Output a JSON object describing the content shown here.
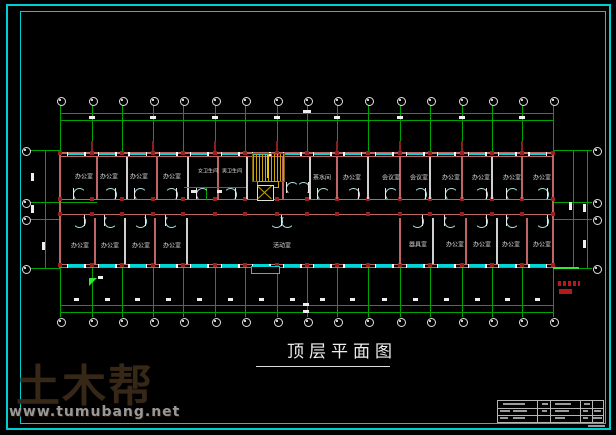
{
  "sheet": {
    "background": "#000000",
    "border_color": "#00cdd4"
  },
  "title": {
    "text": "顶层平面图"
  },
  "watermark": {
    "logo_text": "土木帮",
    "url_text": "www.tumubang.net"
  },
  "plan": {
    "grid_columns_x": [
      60,
      92,
      122,
      153,
      183,
      215,
      245,
      277,
      307,
      337,
      368,
      400,
      430,
      462,
      492,
      522,
      553
    ],
    "side_bubble_ys": [
      150,
      202,
      219,
      268
    ],
    "building": {
      "left": 60,
      "right": 553,
      "top": 152,
      "corridor_top": 199,
      "corridor_bottom": 214,
      "bottom": 267
    },
    "rooms_top": [
      {
        "label": "办公室",
        "x": 84,
        "y": 176
      },
      {
        "label": "办公室",
        "x": 109,
        "y": 176
      },
      {
        "label": "办公室",
        "x": 139,
        "y": 176
      },
      {
        "label": "办公室",
        "x": 172,
        "y": 176
      },
      {
        "label": "女卫生间",
        "x": 208,
        "y": 171,
        "fs": 5
      },
      {
        "label": "男卫生间",
        "x": 232,
        "y": 171,
        "fs": 5
      },
      {
        "label": "茶水间",
        "x": 322,
        "y": 177
      },
      {
        "label": "办公室",
        "x": 352,
        "y": 177
      },
      {
        "label": "会议室",
        "x": 391,
        "y": 177
      },
      {
        "label": "会议室",
        "x": 419,
        "y": 177
      },
      {
        "label": "办公室",
        "x": 451,
        "y": 177
      },
      {
        "label": "办公室",
        "x": 481,
        "y": 177
      },
      {
        "label": "办公室",
        "x": 512,
        "y": 177
      },
      {
        "label": "办公室",
        "x": 542,
        "y": 177
      }
    ],
    "rooms_bottom": [
      {
        "label": "办公室",
        "x": 80,
        "y": 245
      },
      {
        "label": "办公室",
        "x": 110,
        "y": 245
      },
      {
        "label": "办公室",
        "x": 141,
        "y": 245
      },
      {
        "label": "办公室",
        "x": 172,
        "y": 245
      },
      {
        "label": "活动室",
        "x": 282,
        "y": 245
      },
      {
        "label": "器具室",
        "x": 418,
        "y": 244
      },
      {
        "label": "办公室",
        "x": 455,
        "y": 244
      },
      {
        "label": "办公室",
        "x": 482,
        "y": 244
      },
      {
        "label": "办公室",
        "x": 511,
        "y": 244
      },
      {
        "label": "办公室",
        "x": 542,
        "y": 244
      }
    ],
    "partitions_top": [
      97,
      127,
      157,
      188,
      218,
      247,
      283,
      310,
      337,
      368,
      400,
      430,
      462,
      492,
      522
    ],
    "partitions_bottom": [
      95,
      125,
      155,
      187,
      400,
      433,
      466,
      497,
      527
    ],
    "doors_top": [
      73,
      104,
      134,
      165,
      196,
      224,
      317,
      347,
      385,
      414,
      445,
      475,
      506,
      536
    ],
    "doors_bottom": [
      73,
      104,
      134,
      165,
      411,
      444,
      475,
      506,
      536
    ],
    "stair": {
      "x": 252,
      "y": 153,
      "w": 31,
      "h": 27
    },
    "colors": {
      "grid_green": "#00a400",
      "wall_red": "#c06565",
      "column_red": "#9a2020",
      "window_cyan": "#00d4d4",
      "stair_yellow": "#c8a400",
      "door_cyan": "#aadede",
      "label_white": "#dcdcdc",
      "dim_white": "#efefef",
      "highlight_green": "#35e835",
      "note_red": "#b31a1a"
    }
  }
}
